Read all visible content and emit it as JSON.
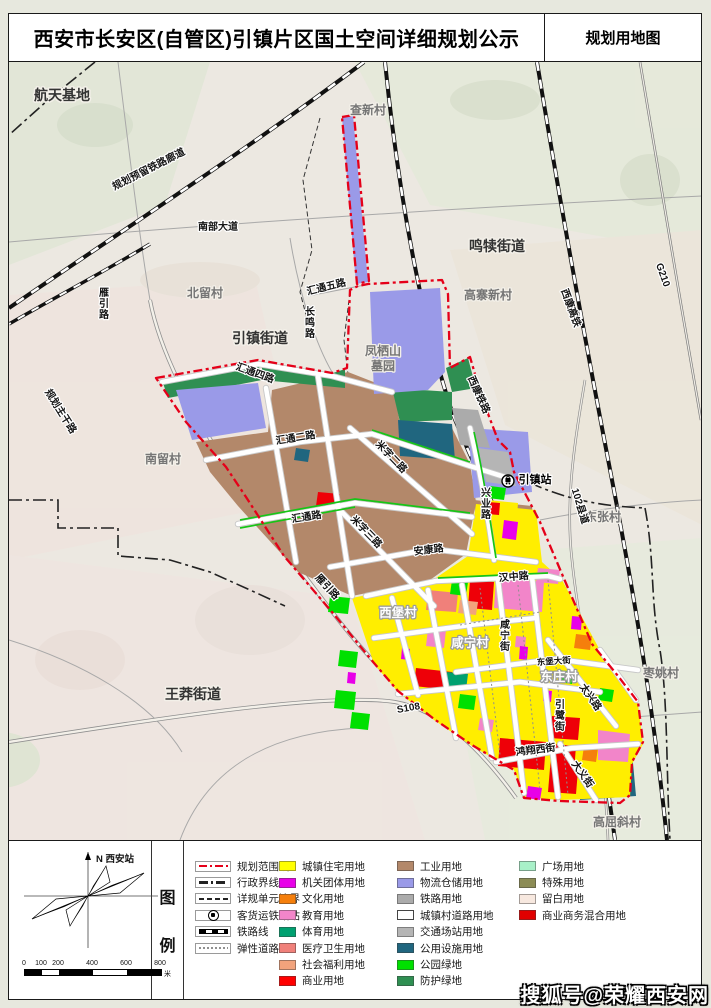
{
  "header": {
    "title": "西安市长安区(自管区)引镇片区国土空间详细规划公示",
    "map_type": "规划用地图"
  },
  "legend": {
    "panel_label": [
      "图",
      "例"
    ],
    "compass_north": "N 西安站",
    "scale_ticks": [
      "0",
      "100",
      "200",
      "400",
      "600",
      "800"
    ],
    "scale_unit": "米",
    "line_items": [
      {
        "label": "规划范围线",
        "sym": "plan"
      },
      {
        "label": "行政界线",
        "sym": "admin"
      },
      {
        "label": "详规单元边界",
        "sym": "unit"
      },
      {
        "label": "客货运铁路站",
        "sym": "station"
      },
      {
        "label": "铁路线",
        "sym": "rail"
      },
      {
        "label": "弹性道路",
        "sym": "elastic"
      }
    ],
    "landuse_col1": [
      {
        "label": "城镇住宅用地",
        "color": "#ffff00"
      },
      {
        "label": "机关团体用地",
        "color": "#e800e8"
      },
      {
        "label": "文化用地",
        "color": "#f57f0c"
      },
      {
        "label": "教育用地",
        "color": "#f285c9"
      },
      {
        "label": "体育用地",
        "color": "#00a070"
      },
      {
        "label": "医疗卫生用地",
        "color": "#f0807a"
      },
      {
        "label": "社会福利用地",
        "color": "#f2a37c"
      },
      {
        "label": "商业用地",
        "color": "#ff0000"
      }
    ],
    "landuse_col2": [
      {
        "label": "工业用地",
        "color": "#b3886a"
      },
      {
        "label": "物流仓储用地",
        "color": "#9a9ae8"
      },
      {
        "label": "铁路用地",
        "color": "#ababab"
      },
      {
        "label": "城镇村道路用地",
        "color": "#ffffff",
        "border": true
      },
      {
        "label": "交通场站用地",
        "color": "#b5b5b5"
      },
      {
        "label": "公用设施用地",
        "color": "#20667f"
      },
      {
        "label": "公园绿地",
        "color": "#00e000"
      },
      {
        "label": "防护绿地",
        "color": "#2f8f52"
      }
    ],
    "landuse_col3": [
      {
        "label": "广场用地",
        "color": "#a8f0c8"
      },
      {
        "label": "特殊用地",
        "color": "#8c8c55"
      },
      {
        "label": "留白用地",
        "color": "#f7e8df"
      },
      {
        "label": "商业商务混合用地",
        "color": "#e00000"
      }
    ]
  },
  "watermark": "搜狐号@荣耀西安网",
  "map": {
    "station_name": "引镇站",
    "labels": [
      {
        "t": "航天基地",
        "x": 62,
        "y": 100,
        "cls": "town"
      },
      {
        "t": "查新村",
        "x": 368,
        "y": 114,
        "cls": "village"
      },
      {
        "t": "规划预留铁路廊道",
        "x": 150,
        "y": 172,
        "r": -27,
        "cls": "road"
      },
      {
        "t": "南部大道",
        "x": 218,
        "y": 230,
        "cls": "road"
      },
      {
        "t": "鸣犊街道",
        "x": 497,
        "y": 251,
        "cls": "town"
      },
      {
        "t": "北留村",
        "x": 205,
        "y": 297,
        "cls": "village"
      },
      {
        "t": "汇通五路",
        "x": 327,
        "y": 290,
        "r": -14,
        "cls": "road"
      },
      {
        "t": "高寨新村",
        "x": 488,
        "y": 299,
        "cls": "village"
      },
      {
        "t": "G210",
        "x": 660,
        "y": 276,
        "r": 70,
        "cls": "road"
      },
      {
        "t": "雁引路",
        "x": 104,
        "y": 296,
        "v": true,
        "cls": "road"
      },
      {
        "t": "长鸣路",
        "x": 310,
        "y": 315,
        "v": true,
        "cls": "road"
      },
      {
        "t": "引镇街道",
        "x": 260,
        "y": 343,
        "cls": "town"
      },
      {
        "t": "凤栖山",
        "x": 383,
        "y": 355,
        "cls": "village"
      },
      {
        "t": "墓园",
        "x": 383,
        "y": 370,
        "cls": "village"
      },
      {
        "t": "汇通四路",
        "x": 254,
        "y": 376,
        "r": 20,
        "cls": "road"
      },
      {
        "t": "西康铁路",
        "x": 476,
        "y": 396,
        "r": 66,
        "cls": "road"
      },
      {
        "t": "西康高铁",
        "x": 568,
        "y": 309,
        "r": 70,
        "cls": "road"
      },
      {
        "t": "规划主干路",
        "x": 58,
        "y": 413,
        "r": 58,
        "cls": "road"
      },
      {
        "t": "汇通二路",
        "x": 296,
        "y": 441,
        "r": -9,
        "cls": "road"
      },
      {
        "t": "南留村",
        "x": 163,
        "y": 463,
        "cls": "village"
      },
      {
        "t": "米字二路",
        "x": 389,
        "y": 459,
        "r": 46,
        "cls": "road"
      },
      {
        "t": "引镇站",
        "x": 535,
        "y": 483,
        "cls": "station"
      },
      {
        "t": "兴业路",
        "x": 486,
        "y": 496,
        "v": true,
        "cls": "road"
      },
      {
        "t": "汇通路",
        "x": 307,
        "y": 520,
        "r": -9,
        "cls": "road"
      },
      {
        "t": "东张村",
        "x": 603,
        "y": 521,
        "cls": "village"
      },
      {
        "t": "102县道",
        "x": 577,
        "y": 507,
        "r": 73,
        "cls": "road"
      },
      {
        "t": "米字三路",
        "x": 364,
        "y": 534,
        "r": 46,
        "cls": "road"
      },
      {
        "t": "安康路",
        "x": 429,
        "y": 553,
        "r": -7,
        "cls": "road"
      },
      {
        "t": "汉中路",
        "x": 514,
        "y": 580,
        "r": -5,
        "cls": "road"
      },
      {
        "t": "雁引路",
        "x": 325,
        "y": 589,
        "r": 47,
        "cls": "road"
      },
      {
        "t": "西堡村",
        "x": 398,
        "y": 617,
        "cls": "village-w"
      },
      {
        "t": "咸宁村",
        "x": 470,
        "y": 647,
        "cls": "village-w"
      },
      {
        "t": "咸宁街",
        "x": 505,
        "y": 628,
        "v": true,
        "cls": "road"
      },
      {
        "t": "东堡大街",
        "x": 554,
        "y": 664,
        "r": -4,
        "cls": "road-sm"
      },
      {
        "t": "东庄村",
        "x": 559,
        "y": 681,
        "cls": "village-w"
      },
      {
        "t": "太兴路",
        "x": 588,
        "y": 699,
        "r": 55,
        "cls": "road"
      },
      {
        "t": "枣姚村",
        "x": 661,
        "y": 677,
        "cls": "village"
      },
      {
        "t": "王莽街道",
        "x": 193,
        "y": 699,
        "cls": "town"
      },
      {
        "t": "S108",
        "x": 409,
        "y": 711,
        "r": -10,
        "cls": "road"
      },
      {
        "t": "引鹭街",
        "x": 560,
        "y": 708,
        "v": true,
        "cls": "road"
      },
      {
        "t": "鸿翔西街",
        "x": 536,
        "y": 753,
        "r": -7,
        "cls": "road"
      },
      {
        "t": "大义街",
        "x": 580,
        "y": 776,
        "r": 55,
        "cls": "road"
      },
      {
        "t": "高屈斜村",
        "x": 617,
        "y": 826,
        "cls": "village"
      }
    ]
  }
}
